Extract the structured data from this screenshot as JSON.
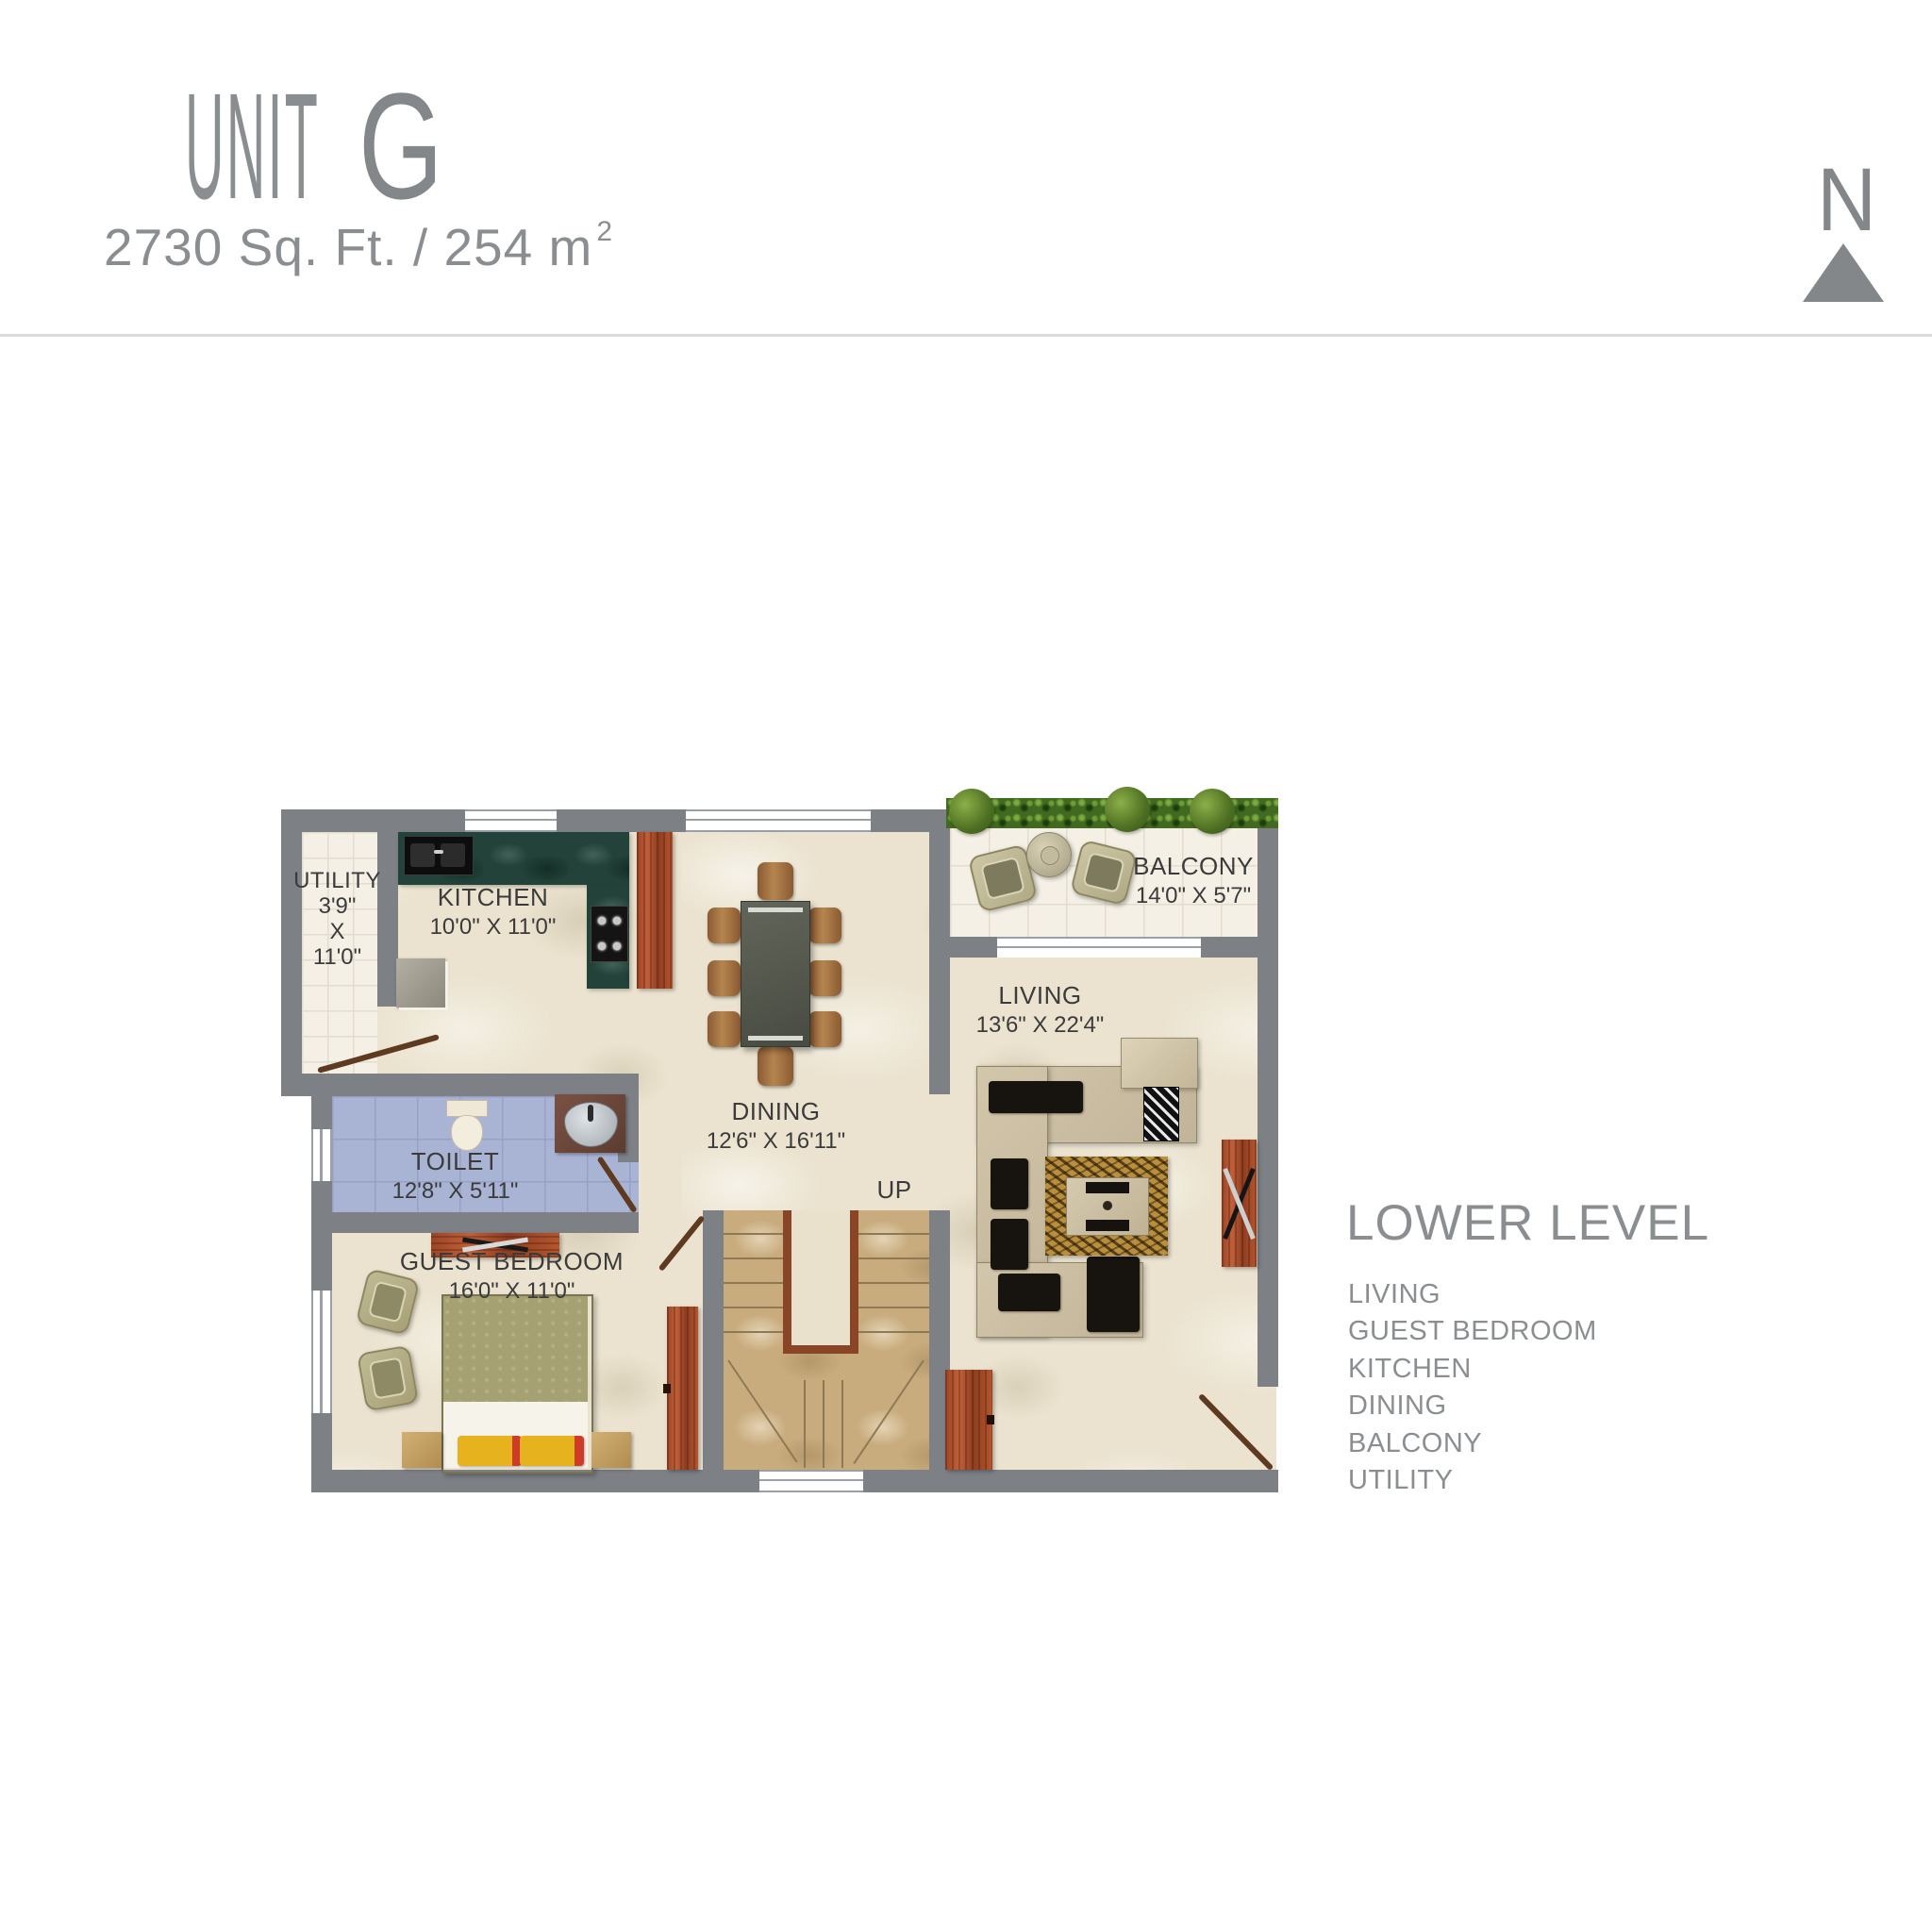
{
  "header": {
    "title_word": "UNIT",
    "title_letter": "G",
    "area_text": "2730 Sq. Ft. / 254 m",
    "area_superscript": "2",
    "compass_letter": "N"
  },
  "plan": {
    "rooms": {
      "utility": {
        "name": "UTILITY",
        "width": "3'9\"",
        "separator": "X",
        "depth": "11'0\""
      },
      "kitchen": {
        "name": "KITCHEN",
        "dims": "10'0\" X 11'0\""
      },
      "dining": {
        "name": "DINING",
        "dims": "12'6\" X 16'11\""
      },
      "balcony": {
        "name": "BALCONY",
        "dims": "14'0\" X 5'7\""
      },
      "living": {
        "name": "LIVING",
        "dims": "13'6\" X 22'4\""
      },
      "toilet": {
        "name": "TOILET",
        "dims": "12'8\" X 5'11\""
      },
      "guest_bedroom": {
        "name": "GUEST BEDROOM",
        "dims": "16'0\" X 11'0\""
      },
      "stairs_label": "UP"
    }
  },
  "legend": {
    "title": "LOWER LEVEL",
    "items": [
      "LIVING",
      "GUEST BEDROOM",
      "KITCHEN",
      "DINING",
      "BALCONY",
      "UTILITY"
    ]
  },
  "colors": {
    "title_gray": "#8b8e91",
    "label_dark": "#3b3b3b",
    "wall_gray": "#7d8186",
    "marble_floor": "#ebe3cf",
    "tile_floor": "#f4f0e5",
    "toilet_floor": "#a9b3d3",
    "stair_floor": "#c9ac7e",
    "counter_green": "#23423a",
    "wood_red": "#b0532b",
    "hedge_green": "#41691f",
    "bed_olive": "#a6a172",
    "pillow_yellow": "#e6b31f",
    "pillow_red": "#cf3b28",
    "sofa_beige": "#cbbfa4",
    "divider_line": "#dadada"
  }
}
